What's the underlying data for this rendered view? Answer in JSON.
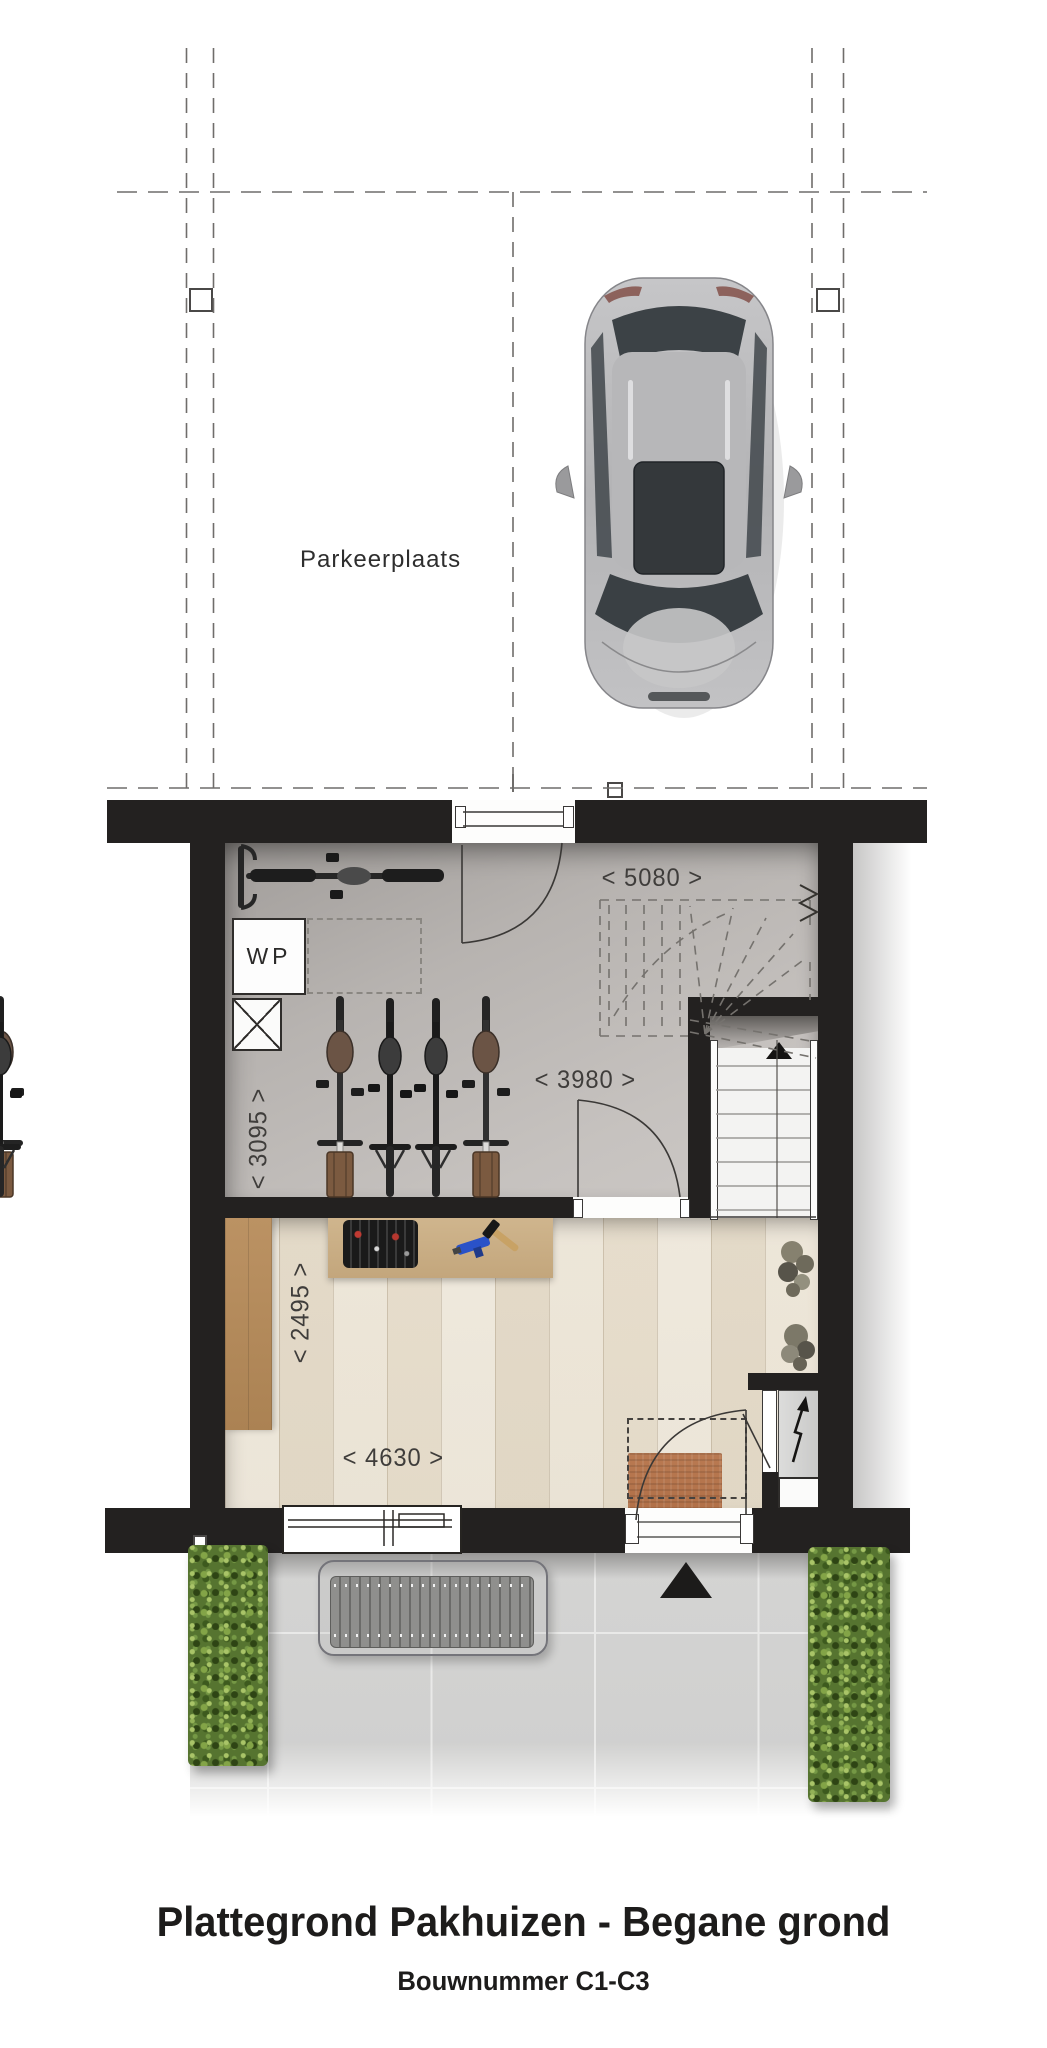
{
  "plan": {
    "parking": {
      "label": "Parkeerplaats"
    },
    "garage": {
      "heat_pump_label": "WP",
      "dim_top": "< 5080 >",
      "dim_inner": "< 3980 >",
      "dim_side": "< 3095 >"
    },
    "workshop": {
      "dim_side": "< 2495 >",
      "dim_bottom": "< 4630 >"
    },
    "footer": {
      "title": "Plattegrond Pakhuizen - Begane grond",
      "subtitle": "Bouwnummer C1-C3"
    }
  },
  "colors": {
    "wall": "#232120",
    "garage_floor": "#bdbab7",
    "wood_floor": "#e9e1d1",
    "tile": "#d2d2d1",
    "hedge_green": "#567430",
    "doormat": "#b97a52",
    "workbench": "#c9ad83"
  }
}
